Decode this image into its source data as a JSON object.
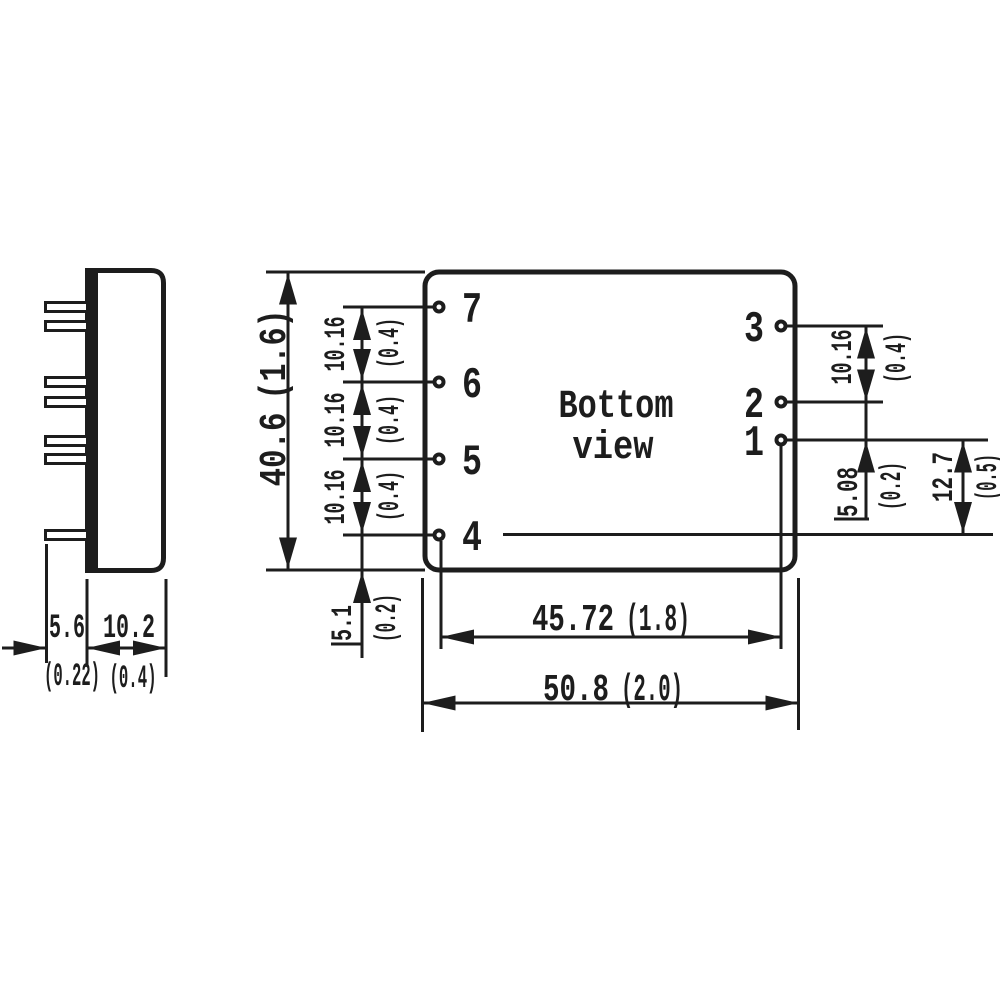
{
  "colors": {
    "ink": "#1d1d1d",
    "background": "#ffffff"
  },
  "side_view": {
    "dim_pin_length": {
      "mm": "5.6",
      "inch": "(0.22)"
    },
    "dim_case_depth": {
      "mm": "10.2",
      "inch": "(0.4)"
    }
  },
  "bottom_view": {
    "title": {
      "line1": "Bottom",
      "line2": "view"
    },
    "pin_labels": {
      "p7": "7",
      "p6": "6",
      "p5": "5",
      "p4": "4",
      "p3": "3",
      "p2": "2",
      "p1": "1"
    },
    "dims": {
      "case_height": {
        "mm": "40.6",
        "inch": "(1.6)"
      },
      "pitch_7_6": {
        "mm": "10.16",
        "inch": "(0.4)"
      },
      "pitch_6_5": {
        "mm": "10.16",
        "inch": "(0.4)"
      },
      "pitch_5_4": {
        "mm": "10.16",
        "inch": "(0.4)"
      },
      "pin4_to_edge": {
        "mm": "5.1",
        "inch": "(0.2)"
      },
      "pitch_3_2": {
        "mm": "10.16",
        "inch": "(0.4)"
      },
      "pitch_2_1": {
        "mm": "5.08",
        "inch": "(0.2)"
      },
      "pin1_to_pin4_row": {
        "mm": "12.7",
        "inch": "(0.5)"
      },
      "pin_span": {
        "mm": "45.72",
        "inch": "(1.8)"
      },
      "case_width": {
        "mm": "50.8",
        "inch": "(2.0)"
      }
    }
  }
}
